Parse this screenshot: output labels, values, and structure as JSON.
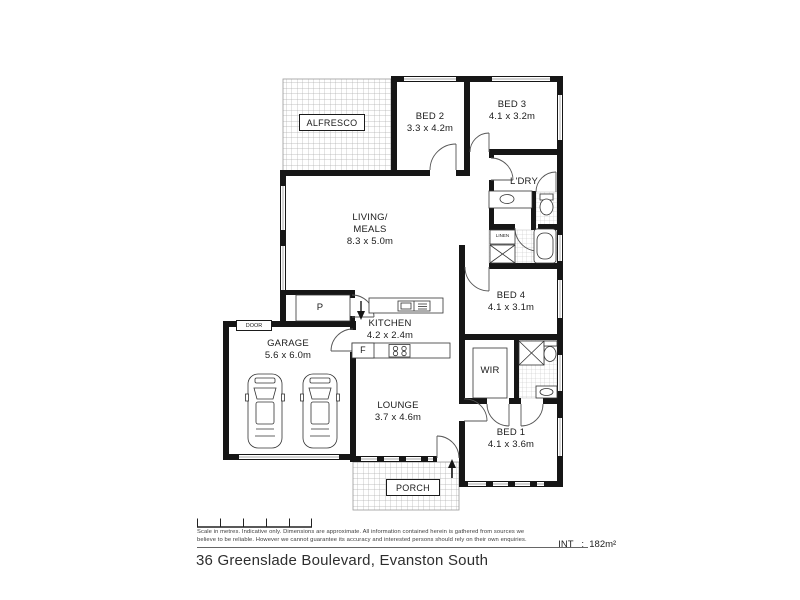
{
  "plan": {
    "rooms": {
      "alfresco": {
        "name": "ALFRESCO"
      },
      "bed2": {
        "name": "BED 2",
        "dims": "3.3 x 4.2m"
      },
      "bed3": {
        "name": "BED 3",
        "dims": "4.1 x 3.2m"
      },
      "laundry": {
        "name": "L'DRY"
      },
      "living": {
        "name": "LIVING/",
        "name2": "MEALS",
        "dims": "8.3 x 5.0m"
      },
      "linen": {
        "name": "LINEN"
      },
      "bed4": {
        "name": "BED 4",
        "dims": "4.1 x 3.1m"
      },
      "kitchen": {
        "name": "KITCHEN",
        "dims": "4.2 x 2.4m"
      },
      "pantry": {
        "name": "P"
      },
      "fridge": {
        "name": "F"
      },
      "garage": {
        "name": "GARAGE",
        "dims": "5.6 x 6.0m",
        "door_label": "DOOR"
      },
      "wir": {
        "name": "WIR"
      },
      "lounge": {
        "name": "LOUNGE",
        "dims": "3.7 x 4.6m"
      },
      "bed1": {
        "name": "BED 1",
        "dims": "4.1 x 3.6m"
      },
      "porch": {
        "name": "PORCH"
      }
    }
  },
  "footer": {
    "disclaimer_line1": "Scale in metres. Indicative only. Dimensions are approximate. All information contained herein is gathered from sources we",
    "disclaimer_line2": "believe to be reliable. However we cannot guarantee its accuracy and interested persons should rely on their own enquiries.",
    "internal_area": "INT   :  182m²",
    "address": "36 Greenslade Boulevard, Evanston South"
  },
  "colors": {
    "wall": "#161616",
    "tile_line": "#c4c4c4",
    "hatch_line": "#b0b0b0"
  }
}
